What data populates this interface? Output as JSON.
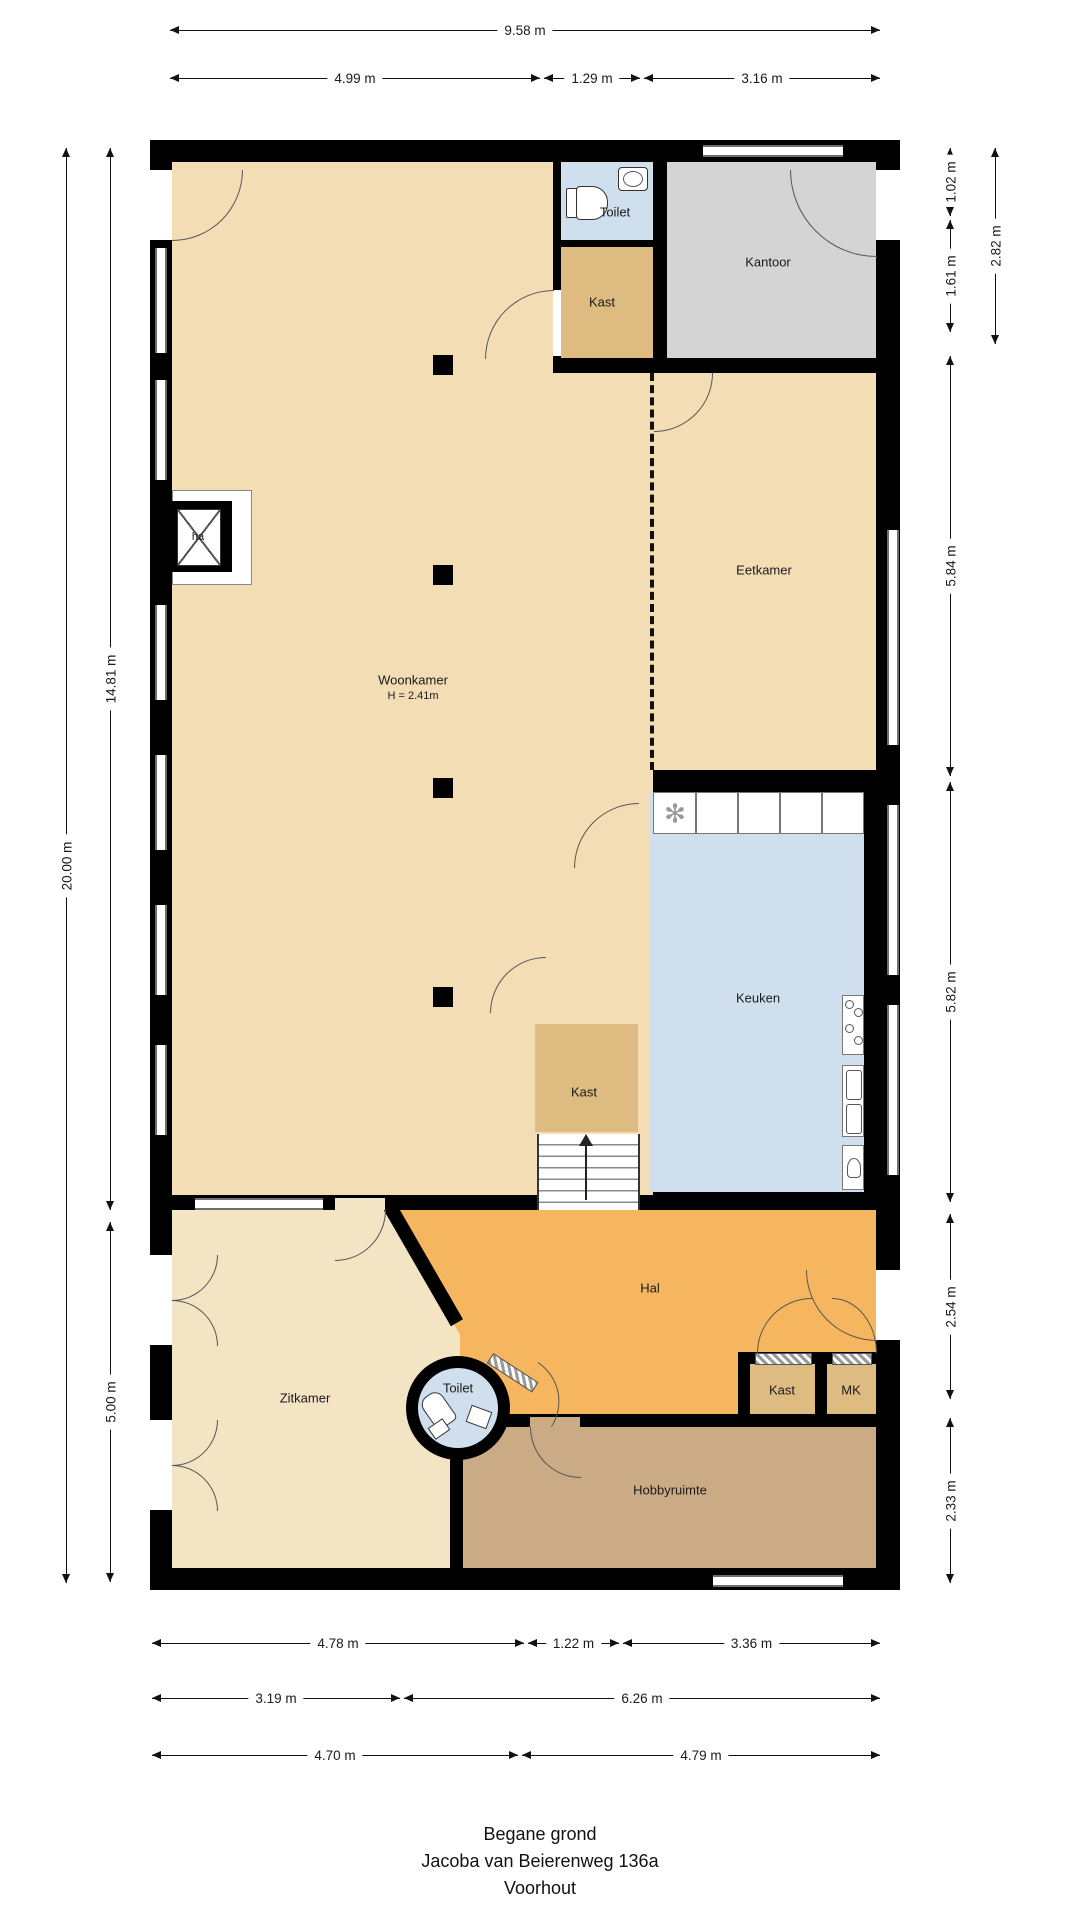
{
  "title": {
    "line1": "Begane grond",
    "line2": "Jacoba van Beierenweg 136a",
    "line3": "Voorhout"
  },
  "dimensions": {
    "top_total": "9.58 m",
    "top_segments": [
      "4.99 m",
      "1.29 m",
      "3.16 m"
    ],
    "left_outer": "20.00 m",
    "left_inner_upper": "14.81 m",
    "left_inner_lower": "5.00 m",
    "right_outer_upper": "2.82 m",
    "right_segments": [
      "1.02 m",
      "1.61 m",
      "5.84 m",
      "5.82 m",
      "2.54 m",
      "2.33 m"
    ],
    "bottom_row1": [
      "4.78 m",
      "1.22 m",
      "3.36 m"
    ],
    "bottom_row2": [
      "3.19 m",
      "6.26 m"
    ],
    "bottom_row3": [
      "4.70 m",
      "4.79 m"
    ]
  },
  "rooms": {
    "woonkamer": {
      "label": "Woonkamer",
      "height_note": "H = 2.41m"
    },
    "eetkamer": {
      "label": "Eetkamer"
    },
    "keuken": {
      "label": "Keuken"
    },
    "kantoor": {
      "label": "Kantoor"
    },
    "toilet_boven": {
      "label": "Toilet"
    },
    "kast_boven": {
      "label": "Kast"
    },
    "kast_midden": {
      "label": "Kast"
    },
    "hal": {
      "label": "Hal"
    },
    "kast_hal": {
      "label": "Kast"
    },
    "mk": {
      "label": "MK"
    },
    "toilet_rond": {
      "label": "Toilet"
    },
    "zitkamer": {
      "label": "Zitkamer"
    },
    "hobbyruimte": {
      "label": "Hobbyruimte"
    },
    "haard": {
      "label": "ha"
    }
  },
  "colors": {
    "floor_cream": "#f3ddb5",
    "floor_cream_light": "#f3e4c3",
    "floor_hal": "#f6b660",
    "floor_hobby": "#cbab85",
    "floor_blue": "#cfdfee",
    "floor_kast": "#debc81",
    "floor_kantoor": "#d4d4d4",
    "wall": "#000000"
  }
}
